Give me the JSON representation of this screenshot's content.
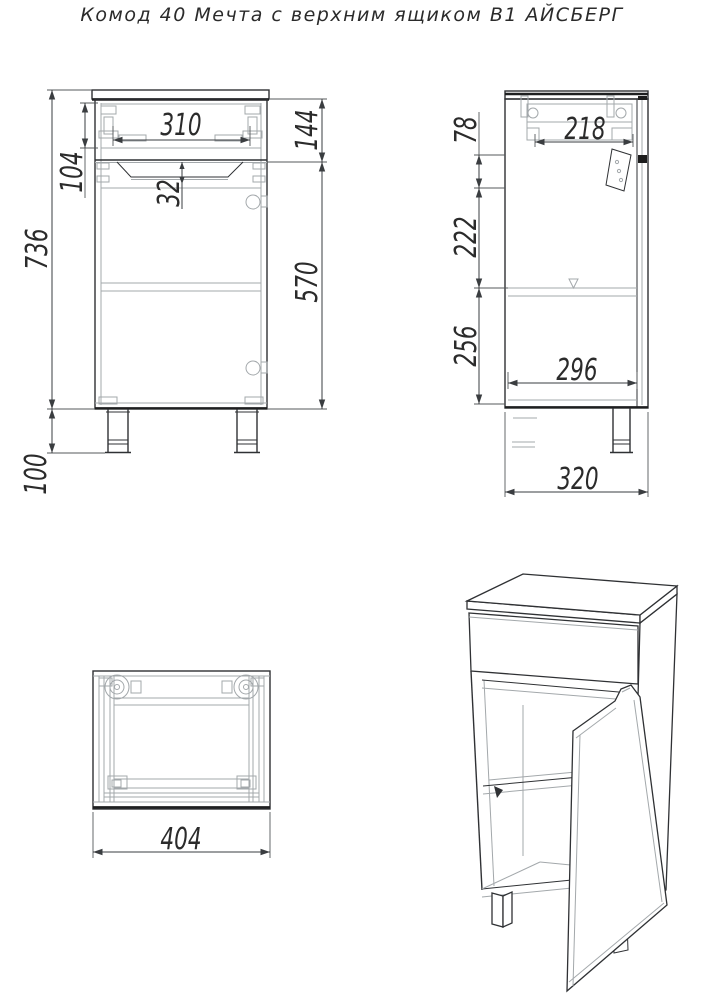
{
  "title": "Комод 40 Мечта с верхним ящиком В1 АЙСБЕРГ",
  "colors": {
    "line": "#2f3134",
    "faint": "#a3a8ab",
    "dim": "#3a3d40",
    "text": "#2b2b2b",
    "background": "#ffffff"
  },
  "views": {
    "front": {
      "dimensions": {
        "drawer_opening_width": "310",
        "drawer_front_section_height": "144",
        "drawer_box_height": "104",
        "handle_recess_depth": "32",
        "carcass_height": "736",
        "door_height": "570",
        "leg_height": "100"
      }
    },
    "side": {
      "dimensions": {
        "drawer_depth": "218",
        "top_offset": "78",
        "middle_section": "222",
        "bottom_section": "256",
        "inner_depth": "296",
        "overall_depth": "320"
      }
    },
    "top": {
      "dimensions": {
        "overall_width": "404"
      }
    }
  }
}
